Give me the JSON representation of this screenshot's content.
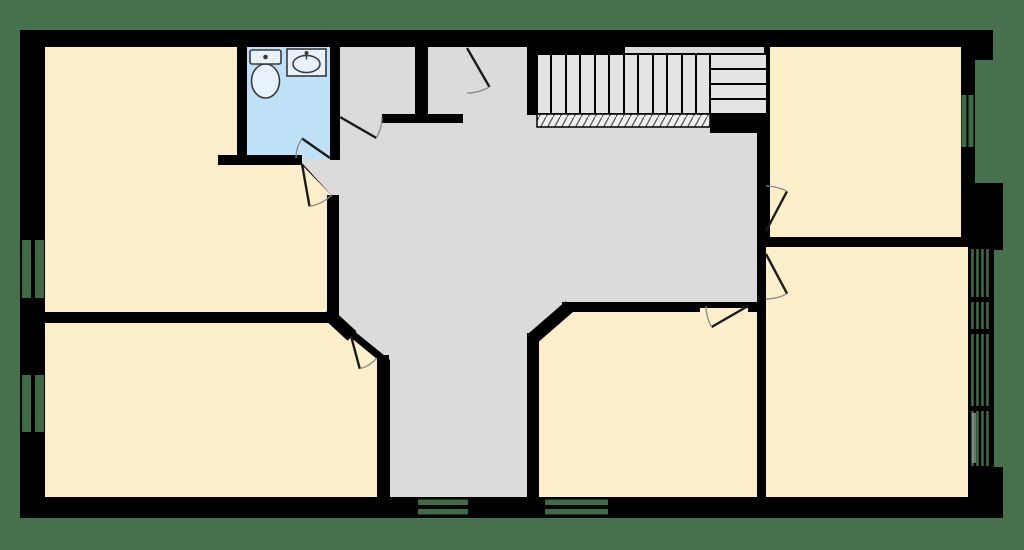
{
  "colors": {
    "background": "#47704D",
    "wall": "#000000",
    "room_fill": "#FDEFC9",
    "bathroom_fill": "#BFE1F7",
    "hall_fill": "#DBDBDB",
    "stair_fill": "#E3E3E3",
    "window_glass": "#3E6B46",
    "door_panel": "#1A1A1A",
    "door_arc": "#8A8A8A",
    "fixture_fill": "#E7F2FC",
    "fixture_stroke": "#3A3A3A",
    "hatch_fill": "#EFEFEF",
    "hatch_line": "#4D4D4D"
  },
  "plan": {
    "rooms": [
      {
        "id": "bedroom-top-left",
        "fill": "room_fill"
      },
      {
        "id": "bathroom",
        "fill": "bathroom_fill",
        "fixtures": [
          "toilet",
          "sink"
        ]
      },
      {
        "id": "closet-left",
        "fill": "hall_fill"
      },
      {
        "id": "closet-right",
        "fill": "hall_fill"
      },
      {
        "id": "hallway",
        "fill": "hall_fill"
      },
      {
        "id": "bedroom-top-right",
        "fill": "room_fill"
      },
      {
        "id": "bedroom-right",
        "fill": "room_fill"
      },
      {
        "id": "bedroom-bottom-center",
        "fill": "room_fill"
      },
      {
        "id": "bedroom-bottom-left",
        "fill": "room_fill"
      }
    ],
    "staircase": {
      "treads": 12,
      "landing_steps": 4
    },
    "door_count": 8,
    "window_count": 6
  }
}
